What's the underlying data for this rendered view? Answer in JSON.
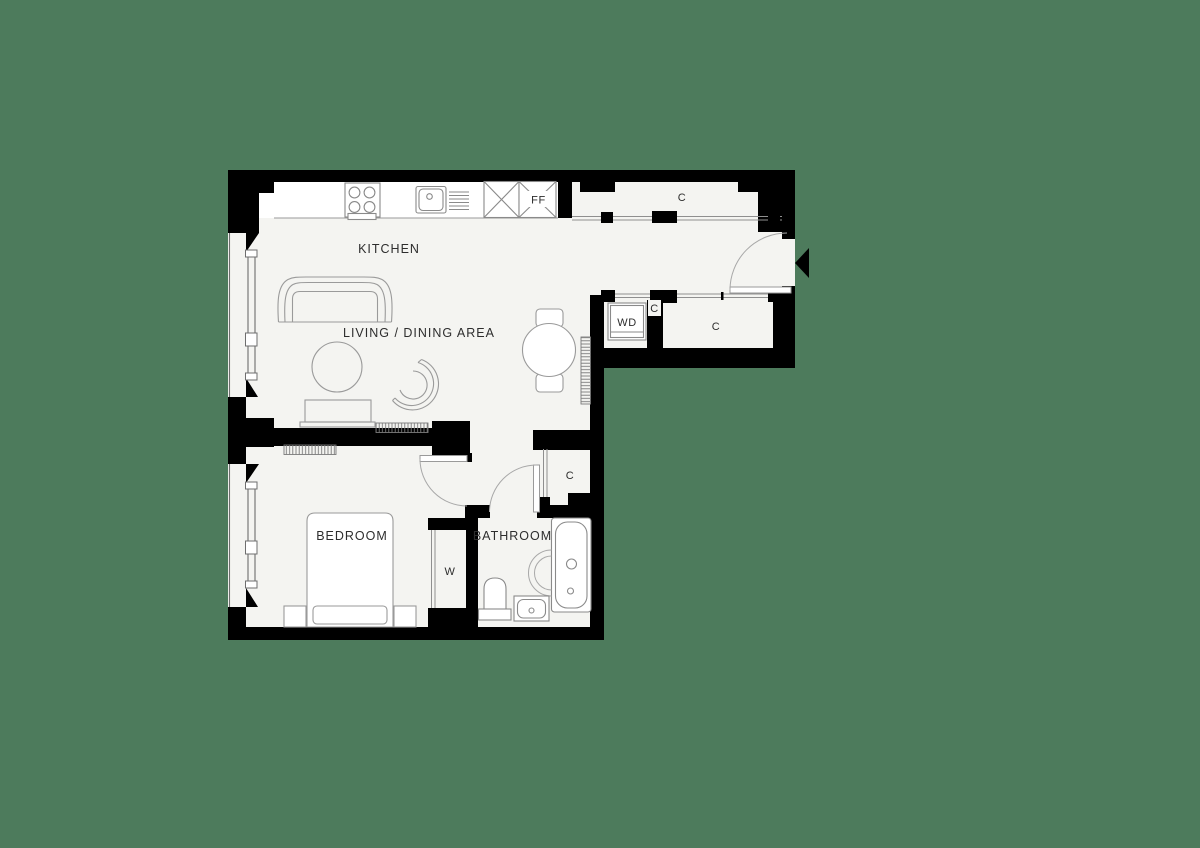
{
  "title": "One-bedroom apartment floor plan",
  "colors": {
    "background": "#4d7b5c",
    "floor": "#f4f4f1",
    "wall": "#000000",
    "furniture_line": "#9a9a9a",
    "fixture_line": "#8a8a8a",
    "label_text": "#2d2d2d"
  },
  "labels": {
    "kitchen": "KITCHEN",
    "living_dining": "LIVING / DINING AREA",
    "bedroom": "BEDROOM",
    "bathroom": "BATHROOM",
    "hall_closet": "C",
    "entry_closet": "C",
    "utility_closet": "C",
    "bathroom_closet": "C",
    "washer_dryer": "WD",
    "fridge_freezer": "FF",
    "wardrobe": "W"
  },
  "icons": {
    "entrance_arrow": "◀ black triangle marking the flat entrance"
  }
}
